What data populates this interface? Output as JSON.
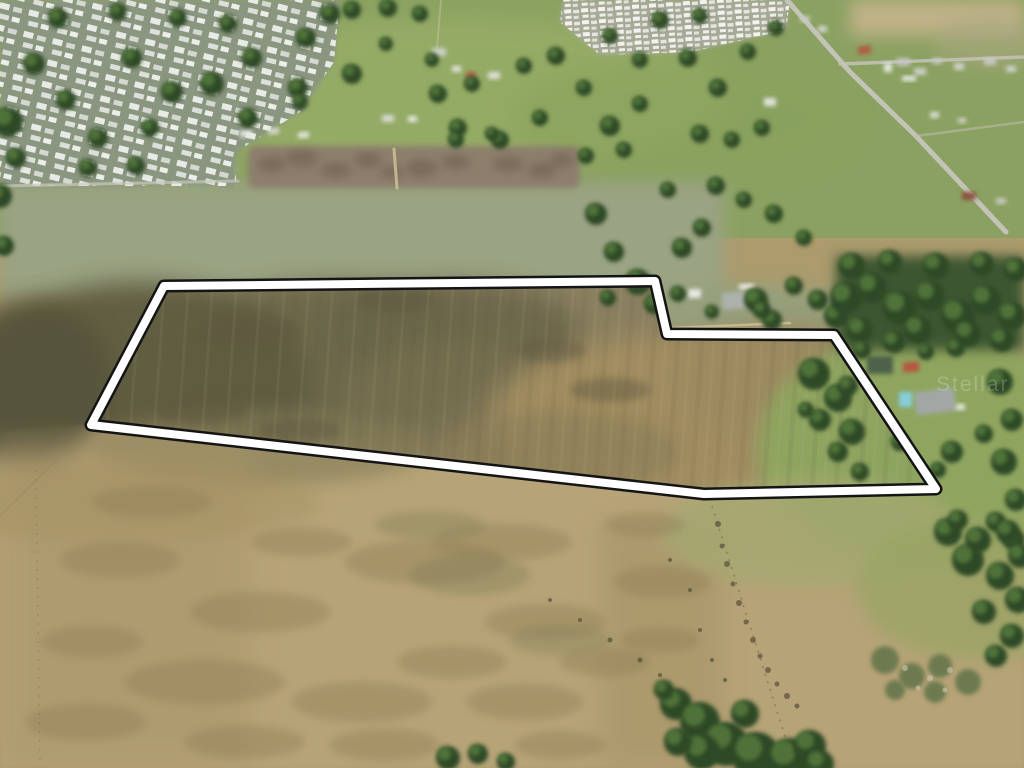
{
  "meta": {
    "description": "Aerial drone photograph of a large vacant land parcel outlined with a white boundary, surrounded by mobile home parks, pastures, scattered homes and oak trees",
    "width": 1024,
    "height": 768
  },
  "watermark": {
    "text": "Stellar",
    "x": 936,
    "y": 391,
    "size": 21,
    "color": "#ffffff",
    "opacity": 0.2,
    "letter_spacing": 2
  },
  "boundary": {
    "points": "164,286 655,281 667,334 834,335 936,489 704,494 91,425",
    "outer_color": "#141414",
    "outer_width": 13,
    "inner_color": "#ffffff",
    "inner_width": 8
  },
  "palette": {
    "tree_dark": "#2e4a28",
    "tree_light": "#557a3c",
    "field_tan": "#b6a377",
    "field_olive": "#6b6649",
    "pasture_green": "#8ba161",
    "road_gray": "#c3c3b8"
  },
  "patch_default": {
    "fill": "#8d7b55",
    "opacity": 0.38,
    "blur": 4
  },
  "speck_default": {
    "fill": "#4a4430",
    "opacity": 0.62
  },
  "regions": [
    {
      "t": "rect",
      "x": 0,
      "y": 0,
      "w": 1024,
      "h": 768,
      "f": "#ab9b6d",
      "o": 1,
      "b": 0
    },
    {
      "t": "rect",
      "x": 0,
      "y": 0,
      "w": 1024,
      "h": 238,
      "f": "#8ba161",
      "o": 1,
      "b": 0
    },
    {
      "t": "ell",
      "cx": 450,
      "cy": 95,
      "rx": 280,
      "ry": 78,
      "f": "#9db46a",
      "o": 0.55,
      "b": 12
    },
    {
      "t": "ell",
      "cx": 185,
      "cy": 168,
      "rx": 52,
      "ry": 22,
      "f": "#a7bc75",
      "o": 0.9,
      "b": 4
    },
    {
      "t": "ell",
      "cx": 680,
      "cy": 118,
      "rx": 170,
      "ry": 60,
      "f": "#89a25d",
      "o": 0.6,
      "b": 12
    },
    {
      "t": "rect",
      "x": 850,
      "y": 0,
      "w": 174,
      "h": 36,
      "f": "#c6b48d",
      "o": 0.9,
      "b": 8
    },
    {
      "t": "ell",
      "cx": 992,
      "cy": 42,
      "rx": 60,
      "ry": 26,
      "f": "#a9a77f",
      "o": 0.6,
      "b": 8
    },
    {
      "t": "ell",
      "cx": 150,
      "cy": 232,
      "rx": 130,
      "ry": 28,
      "f": "#8f9a75",
      "o": 0.5,
      "b": 8
    },
    {
      "t": "ell",
      "cx": 430,
      "cy": 244,
      "rx": 150,
      "ry": 30,
      "f": "#949e78",
      "o": 0.5,
      "b": 8
    },
    {
      "t": "rect",
      "x": 0,
      "y": 182,
      "w": 724,
      "h": 118,
      "f": "#9aa383",
      "o": 1,
      "b": 8
    },
    {
      "t": "ell",
      "cx": 748,
      "cy": 321,
      "rx": 138,
      "ry": 37,
      "f": "#95a07d",
      "o": 0.95,
      "b": 8
    },
    {
      "t": "poly",
      "p": "164,286 655,281 667,334 834,335 936,489 704,494 91,425",
      "f": "#8a8060",
      "o": 1,
      "b": 0
    },
    {
      "t": "ell",
      "cx": 450,
      "cy": 330,
      "rx": 130,
      "ry": 48,
      "f": "#6a654a",
      "o": 0.85,
      "b": 12
    },
    {
      "t": "ell",
      "cx": 330,
      "cy": 362,
      "rx": 160,
      "ry": 80,
      "f": "#6b6649",
      "o": 0.9,
      "b": 12
    },
    {
      "t": "ell",
      "cx": 140,
      "cy": 382,
      "rx": 170,
      "ry": 100,
      "f": "#5f5b40",
      "o": 0.95,
      "b": 12
    },
    {
      "t": "ell",
      "cx": 470,
      "cy": 398,
      "rx": 130,
      "ry": 60,
      "f": "#776f50",
      "o": 0.7,
      "b": 12
    },
    {
      "t": "ell",
      "cx": 680,
      "cy": 420,
      "rx": 190,
      "ry": 85,
      "f": "#a28d61",
      "o": 0.95,
      "b": 12
    },
    {
      "t": "ell",
      "cx": 792,
      "cy": 382,
      "rx": 120,
      "ry": 60,
      "f": "#9c8a60",
      "o": 0.8,
      "b": 12
    },
    {
      "t": "ell",
      "cx": 560,
      "cy": 452,
      "rx": 120,
      "ry": 40,
      "f": "#8d7f58",
      "o": 0.7,
      "b": 8
    },
    {
      "t": "poly",
      "p": "0,432 92,424 704,494 938,489 1024,522 1024,768 0,768",
      "f": "#b6a377",
      "o": 1,
      "b": 2
    },
    {
      "t": "ell",
      "cx": 30,
      "cy": 382,
      "rx": 82,
      "ry": 82,
      "f": "#55523a",
      "o": 0.9,
      "b": 12
    },
    {
      "t": "ell",
      "cx": 262,
      "cy": 447,
      "rx": 170,
      "ry": 38,
      "f": "#847b57",
      "o": 0.6,
      "b": 8
    },
    {
      "t": "rect",
      "x": 0,
      "y": 440,
      "w": 250,
      "h": 328,
      "f": "#a8946a",
      "o": 0.5,
      "b": 12
    },
    {
      "t": "rect",
      "x": 600,
      "y": 522,
      "w": 125,
      "h": 246,
      "f": "#a19064",
      "o": 0.45,
      "b": 12
    },
    {
      "t": "ell",
      "cx": 120,
      "cy": 502,
      "rx": 200,
      "ry": 40,
      "f": "#a39060",
      "o": 0.45,
      "b": 8
    },
    {
      "t": "ell",
      "cx": 925,
      "cy": 448,
      "rx": 168,
      "ry": 118,
      "f": "#8ea65e",
      "o": 0.95,
      "b": 8
    },
    {
      "t": "ell",
      "cx": 812,
      "cy": 532,
      "rx": 150,
      "ry": 55,
      "f": "#a5a871",
      "o": 0.8,
      "b": 8
    },
    {
      "t": "ell",
      "cx": 982,
      "cy": 588,
      "rx": 125,
      "ry": 72,
      "f": "#9aa465",
      "o": 0.8,
      "b": 8
    },
    {
      "t": "rect",
      "x": 836,
      "y": 256,
      "w": 188,
      "h": 94,
      "f": "#3c5631",
      "o": 1,
      "b": 6
    },
    {
      "t": "rect",
      "x": 248,
      "y": 146,
      "w": 332,
      "h": 42,
      "rx": 8,
      "f": "#8d7d6d",
      "o": 0.95,
      "b": 3
    },
    {
      "t": "poly",
      "p": "0,0 340,0 334,62 300,112 236,152 236,186 0,186",
      "f": "#8a9680",
      "o": 1,
      "b": 2
    },
    {
      "t": "poly",
      "p": "0,0 340,0 334,62 300,112 236,152 236,186 0,186",
      "f": "url(#roofs1)",
      "o": 1,
      "b": 0
    },
    {
      "t": "poly",
      "p": "563,0 790,0 786,30 690,52 600,55 560,22",
      "f": "#a7a996",
      "o": 1,
      "b": 2
    },
    {
      "t": "poly",
      "p": "563,0 790,0 786,30 690,52 600,55 560,22",
      "f": "url(#roofs2)",
      "o": 1,
      "b": 0
    }
  ],
  "patches": [
    [
      120,
      560,
      60,
      18
    ],
    [
      260,
      612,
      70,
      20
    ],
    [
      425,
      562,
      80,
      22
    ],
    [
      545,
      622,
      60,
      18
    ],
    [
      662,
      582,
      48,
      16
    ],
    [
      205,
      682,
      80,
      22
    ],
    [
      362,
      702,
      70,
      20
    ],
    [
      525,
      702,
      58,
      18
    ],
    [
      92,
      642,
      50,
      16
    ],
    [
      302,
      542,
      50,
      14
    ],
    [
      452,
      662,
      55,
      16
    ],
    [
      605,
      662,
      45,
      14
    ],
    [
      152,
      502,
      60,
      16
    ],
    [
      502,
      542,
      70,
      18
    ],
    [
      645,
      525,
      40,
      12
    ],
    [
      86,
      722,
      60,
      18
    ],
    [
      245,
      742,
      60,
      16
    ],
    [
      385,
      745,
      55,
      16
    ],
    [
      560,
      745,
      45,
      14
    ],
    [
      660,
      640,
      40,
      12
    ],
    [
      470,
      575,
      60,
      20,
      "#7b7a52",
      0.35
    ],
    [
      560,
      640,
      50,
      16,
      "#7b7a52",
      0.3
    ],
    [
      430,
      525,
      55,
      14,
      "#77764f",
      0.3
    ],
    [
      272,
      164,
      14,
      8,
      "#6a5c4d",
      0.5
    ],
    [
      302,
      158,
      16,
      9,
      "#6a5c4d",
      0.5
    ],
    [
      336,
      170,
      15,
      8,
      "#6a5c4d",
      0.5
    ],
    [
      368,
      160,
      14,
      8,
      "#6a5c4d",
      0.5
    ],
    [
      422,
      168,
      16,
      9,
      "#6a5c4d",
      0.5
    ],
    [
      456,
      162,
      14,
      8,
      "#6a5c4d",
      0.5
    ],
    [
      508,
      164,
      15,
      8,
      "#6a5c4d",
      0.5
    ],
    [
      542,
      170,
      14,
      8,
      "#6a5c4d",
      0.5
    ],
    [
      562,
      160,
      12,
      7,
      "#6a5c4d",
      0.5
    ],
    [
      392,
      172,
      12,
      6,
      "#6a5c4d",
      0.5
    ],
    [
      395,
      300,
      40,
      14,
      "#5e5940",
      0.5
    ],
    [
      250,
      330,
      50,
      16,
      "#5e5940",
      0.5
    ],
    [
      200,
      410,
      45,
      14,
      "#5e5940",
      0.5
    ],
    [
      300,
      430,
      40,
      12,
      "#5e5940",
      0.5
    ],
    [
      550,
      350,
      35,
      12,
      "#5e5940",
      0.45
    ],
    [
      610,
      390,
      40,
      12,
      "#5e5940",
      0.45
    ]
  ],
  "roads": [
    {
      "p": "787,0 850,72 916,136 1006,232",
      "w": 5,
      "s": "#c3c3b8",
      "o": 1
    },
    {
      "p": "840,64 1024,57",
      "w": 3.5,
      "s": "#c3c3b8",
      "o": 0.85
    },
    {
      "p": "916,136 1024,122",
      "w": 2.5,
      "s": "#bdbdb2",
      "o": 0.55
    },
    {
      "p": "0,186 238,181",
      "w": 3,
      "s": "#c8c9be",
      "o": 0.7
    },
    {
      "p": "394,149 397,188",
      "w": 3,
      "s": "#cfc09a",
      "o": 0.85
    },
    {
      "p": "669,328 790,323",
      "w": 2.5,
      "s": "#d8c69c",
      "o": 0.7
    },
    {
      "p": "441,0 437,48",
      "w": 2,
      "s": "#cbbf9c",
      "o": 0.5
    }
  ],
  "fences": [
    {
      "p": "712,506 795,768",
      "w": 1.5,
      "s": "#574f38",
      "o": 0.45,
      "d": "2 6"
    },
    {
      "p": "36,470 40,768",
      "w": 1.2,
      "s": "#6a6147",
      "o": 0.35,
      "d": "2 7"
    },
    {
      "p": "0,516 91,426",
      "w": 1.2,
      "s": "#8a8261",
      "o": 0.4,
      "d": ""
    }
  ],
  "buildings": [
    [
      240,
      130,
      12,
      7,
      "#e6e8e2",
      -6
    ],
    [
      268,
      128,
      11,
      6,
      "#dadcd6",
      -6
    ],
    [
      298,
      132,
      11,
      6,
      "#e6e8e2",
      -4
    ],
    [
      432,
      48,
      14,
      8,
      "#cfd3cc",
      0
    ],
    [
      452,
      66,
      9,
      6,
      "#e2e4df",
      0
    ],
    [
      466,
      72,
      10,
      6,
      "#b65a44",
      0
    ],
    [
      488,
      72,
      12,
      7,
      "#dfe1dc",
      0
    ],
    [
      382,
      115,
      12,
      7,
      "#d8dbd5",
      0
    ],
    [
      408,
      116,
      9,
      6,
      "#e8eae5",
      0
    ],
    [
      800,
      16,
      10,
      6,
      "#c9ccc6",
      0
    ],
    [
      818,
      26,
      9,
      6,
      "#d5d8d2",
      0
    ],
    [
      858,
      46,
      13,
      8,
      "#b05a43",
      -8
    ],
    [
      884,
      63,
      8,
      9,
      "#e8e8e4",
      0
    ],
    [
      896,
      58,
      14,
      8,
      "#c2c6c2",
      0
    ],
    [
      914,
      68,
      12,
      7,
      "#cdd0cb",
      0
    ],
    [
      932,
      58,
      10,
      6,
      "#c6c9c4",
      0
    ],
    [
      954,
      63,
      10,
      7,
      "#d0d3cd",
      0
    ],
    [
      984,
      58,
      12,
      7,
      "#c9ccc6",
      0
    ],
    [
      1006,
      66,
      10,
      6,
      "#d2d5cf",
      0
    ],
    [
      764,
      98,
      12,
      8,
      "#e3e5e0",
      0
    ],
    [
      930,
      112,
      9,
      6,
      "#dee0db",
      0
    ],
    [
      958,
      118,
      8,
      5,
      "#d5d8d2",
      0
    ],
    [
      902,
      76,
      14,
      5,
      "#eceee9",
      0
    ],
    [
      962,
      192,
      14,
      8,
      "#8e4f41",
      0
    ],
    [
      996,
      198,
      10,
      6,
      "#c9ccc6",
      0
    ],
    [
      688,
      289,
      13,
      9,
      "#e9ebe6",
      0
    ],
    [
      722,
      292,
      27,
      17,
      "#aeb2ae",
      -4
    ],
    [
      739,
      284,
      15,
      5,
      "#f0f1ed",
      -2
    ],
    [
      867,
      356,
      26,
      18,
      "#4c6148",
      0
    ],
    [
      903,
      362,
      16,
      10,
      "#b5543f",
      -6
    ],
    [
      915,
      390,
      40,
      23,
      "#a3a8a8",
      -7
    ],
    [
      899,
      392,
      13,
      15,
      "#85d0de",
      0
    ],
    [
      956,
      404,
      9,
      6,
      "#e6e8e3",
      0
    ]
  ],
  "trees": [
    [
      8,
      122,
      15
    ],
    [
      34,
      64,
      11
    ],
    [
      66,
      100,
      10
    ],
    [
      98,
      138,
      10
    ],
    [
      132,
      58,
      10
    ],
    [
      172,
      92,
      11
    ],
    [
      212,
      84,
      12
    ],
    [
      252,
      58,
      10
    ],
    [
      298,
      88,
      10
    ],
    [
      150,
      128,
      9
    ],
    [
      248,
      118,
      10
    ],
    [
      306,
      38,
      10
    ],
    [
      330,
      14,
      10
    ],
    [
      228,
      24,
      9
    ],
    [
      178,
      18,
      9
    ],
    [
      118,
      12,
      9
    ],
    [
      58,
      18,
      10
    ],
    [
      16,
      158,
      10
    ],
    [
      88,
      168,
      9
    ],
    [
      136,
      166,
      9
    ],
    [
      0,
      196,
      12
    ],
    [
      4,
      246,
      10
    ],
    [
      352,
      10,
      9
    ],
    [
      388,
      8,
      9
    ],
    [
      420,
      14,
      8
    ],
    [
      352,
      74,
      10
    ],
    [
      300,
      102,
      8
    ],
    [
      386,
      44,
      7
    ],
    [
      438,
      94,
      9
    ],
    [
      458,
      128,
      9
    ],
    [
      500,
      140,
      9
    ],
    [
      540,
      118,
      8
    ],
    [
      432,
      60,
      7
    ],
    [
      472,
      84,
      8
    ],
    [
      524,
      66,
      8
    ],
    [
      556,
      56,
      9
    ],
    [
      584,
      88,
      8
    ],
    [
      610,
      126,
      10
    ],
    [
      640,
      104,
      8
    ],
    [
      586,
      156,
      8
    ],
    [
      624,
      150,
      8
    ],
    [
      660,
      20,
      9
    ],
    [
      688,
      58,
      9
    ],
    [
      718,
      88,
      9
    ],
    [
      748,
      52,
      8
    ],
    [
      776,
      28,
      8
    ],
    [
      700,
      16,
      8
    ],
    [
      640,
      60,
      8
    ],
    [
      610,
      36,
      8
    ],
    [
      456,
      140,
      8
    ],
    [
      492,
      134,
      7
    ],
    [
      700,
      134,
      9
    ],
    [
      732,
      140,
      8
    ],
    [
      762,
      128,
      8
    ],
    [
      596,
      214,
      11
    ],
    [
      614,
      252,
      10
    ],
    [
      638,
      282,
      13
    ],
    [
      654,
      304,
      10
    ],
    [
      608,
      298,
      8
    ],
    [
      682,
      248,
      10
    ],
    [
      702,
      228,
      9
    ],
    [
      668,
      190,
      8
    ],
    [
      716,
      186,
      9
    ],
    [
      744,
      200,
      8
    ],
    [
      774,
      214,
      9
    ],
    [
      804,
      238,
      8
    ],
    [
      756,
      300,
      12
    ],
    [
      772,
      320,
      10
    ],
    [
      794,
      286,
      9
    ],
    [
      818,
      300,
      10
    ],
    [
      836,
      316,
      12
    ],
    [
      678,
      294,
      8
    ],
    [
      712,
      312,
      7
    ],
    [
      762,
      310,
      9
    ],
    [
      846,
      298,
      16
    ],
    [
      872,
      288,
      15
    ],
    [
      900,
      308,
      17
    ],
    [
      930,
      296,
      15
    ],
    [
      958,
      316,
      17
    ],
    [
      986,
      300,
      15
    ],
    [
      1012,
      316,
      14
    ],
    [
      860,
      330,
      13
    ],
    [
      918,
      330,
      14
    ],
    [
      968,
      334,
      13
    ],
    [
      1002,
      340,
      12
    ],
    [
      852,
      266,
      13
    ],
    [
      890,
      262,
      12
    ],
    [
      936,
      266,
      13
    ],
    [
      982,
      264,
      12
    ],
    [
      1016,
      270,
      12
    ],
    [
      814,
      374,
      16
    ],
    [
      838,
      398,
      14
    ],
    [
      820,
      420,
      11
    ],
    [
      848,
      386,
      10
    ],
    [
      806,
      410,
      8
    ],
    [
      852,
      432,
      13
    ],
    [
      838,
      452,
      10
    ],
    [
      900,
      442,
      9
    ],
    [
      952,
      452,
      11
    ],
    [
      984,
      434,
      9
    ],
    [
      938,
      470,
      8
    ],
    [
      860,
      472,
      9
    ],
    [
      894,
      342,
      11
    ],
    [
      862,
      350,
      9
    ],
    [
      926,
      352,
      8
    ],
    [
      956,
      348,
      9
    ],
    [
      1000,
      382,
      13
    ],
    [
      1012,
      420,
      11
    ],
    [
      1004,
      462,
      13
    ],
    [
      1016,
      500,
      11
    ],
    [
      996,
      522,
      10
    ],
    [
      1014,
      540,
      11
    ],
    [
      948,
      532,
      14
    ],
    [
      978,
      540,
      13
    ],
    [
      1008,
      532,
      12
    ],
    [
      1020,
      556,
      12
    ],
    [
      958,
      520,
      10
    ],
    [
      968,
      560,
      16
    ],
    [
      1000,
      576,
      14
    ],
    [
      1018,
      600,
      13
    ],
    [
      984,
      612,
      12
    ],
    [
      1012,
      636,
      12
    ],
    [
      996,
      656,
      11
    ],
    [
      885,
      660,
      14,
      "#6d7a50"
    ],
    [
      912,
      676,
      13,
      "#6d7a50"
    ],
    [
      940,
      666,
      12,
      "#6d7a50"
    ],
    [
      968,
      682,
      13,
      "#6d7a50"
    ],
    [
      935,
      692,
      11,
      "#6d7a50"
    ],
    [
      895,
      690,
      10,
      "#6d7a50"
    ],
    [
      676,
      704,
      16
    ],
    [
      700,
      722,
      20
    ],
    [
      726,
      744,
      22
    ],
    [
      756,
      756,
      24
    ],
    [
      790,
      760,
      22
    ],
    [
      702,
      752,
      18
    ],
    [
      678,
      742,
      14
    ],
    [
      745,
      714,
      14
    ],
    [
      810,
      746,
      16
    ],
    [
      664,
      690,
      10
    ],
    [
      820,
      764,
      14
    ],
    [
      448,
      758,
      12
    ],
    [
      478,
      754,
      10
    ],
    [
      506,
      762,
      9
    ]
  ],
  "specks": [
    [
      718,
      524,
      3
    ],
    [
      722,
      546,
      2.5
    ],
    [
      727,
      564,
      3
    ],
    [
      733,
      584,
      2.5
    ],
    [
      739,
      603,
      3
    ],
    [
      746,
      622,
      2.5
    ],
    [
      753,
      640,
      3
    ],
    [
      760,
      656,
      2.5
    ],
    [
      768,
      670,
      3
    ],
    [
      777,
      684,
      2.5
    ],
    [
      787,
      696,
      3
    ],
    [
      797,
      706,
      2.5
    ],
    [
      690,
      590,
      2
    ],
    [
      700,
      630,
      2
    ],
    [
      670,
      560,
      2
    ],
    [
      712,
      660,
      2
    ],
    [
      725,
      680,
      2
    ],
    [
      610,
      640,
      2.5
    ],
    [
      640,
      660,
      2.5
    ],
    [
      660,
      675,
      2
    ],
    [
      580,
      620,
      2
    ],
    [
      550,
      600,
      2
    ],
    [
      905,
      668,
      3,
      "#c9c6b0"
    ],
    [
      930,
      678,
      3,
      "#c9c6b0"
    ],
    [
      950,
      670,
      3,
      "#c9c6b0"
    ],
    [
      918,
      688,
      2.5,
      "#c9c6b0"
    ],
    [
      945,
      690,
      2.5,
      "#c9c6b0"
    ]
  ]
}
